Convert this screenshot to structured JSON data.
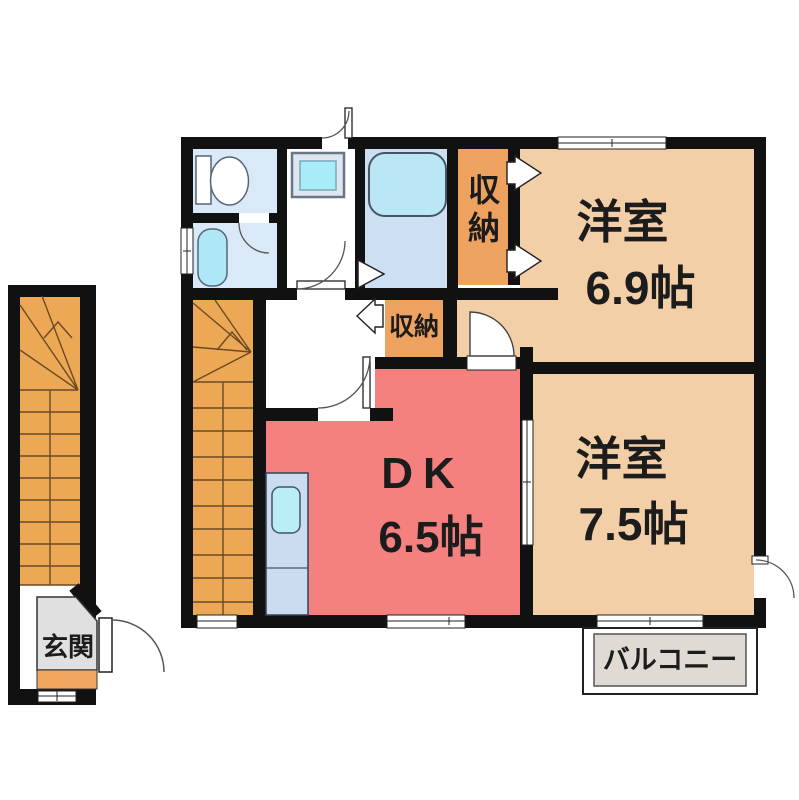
{
  "floor_plan": {
    "wall_color": "#111111",
    "rooms": [
      {
        "name": "洋室",
        "size": "6.9帖",
        "fill": "#f3cfa8"
      },
      {
        "name": "洋室",
        "size": "7.5帖",
        "fill": "#f3cfa8"
      },
      {
        "name": "DK",
        "size": "6.5帖",
        "fill": "#f48080"
      }
    ],
    "closets": [
      {
        "label": "収納"
      },
      {
        "label": "収納"
      }
    ],
    "closet_fill": "#eea260",
    "stairs_fill": "#eca854",
    "water_area_fill": "#d9e9f8",
    "bathroom_fill": "#cddff2",
    "fixture_fill": "#aee8f6",
    "balcony": {
      "label": "バルコニー",
      "fill": "#dfdad3"
    },
    "entrance": {
      "label": "玄関",
      "floor_fill": "#e0e0e0",
      "step_fill": "#f0a861"
    },
    "fixtures": [
      "toilet",
      "washbasin",
      "washing-machine",
      "bathtub",
      "kitchen-sink"
    ]
  }
}
